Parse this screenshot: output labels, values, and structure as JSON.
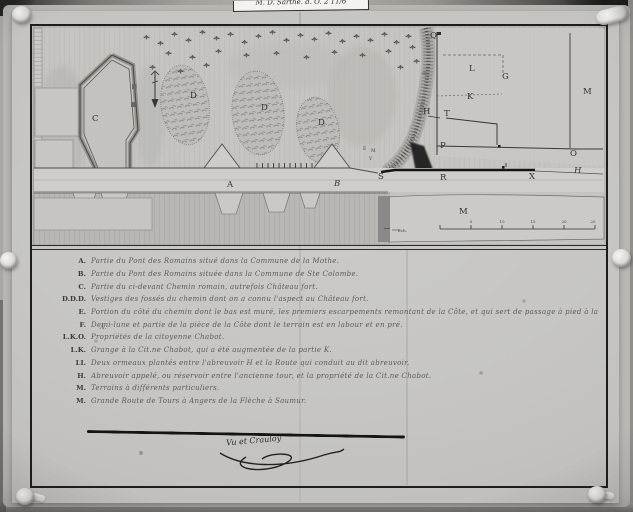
{
  "photo": {
    "archive_label": "M. D. Sarthe. d. O. 2 11/6"
  },
  "map": {
    "letters": [
      "C",
      "D",
      "D",
      "D",
      "A",
      "B",
      "Q",
      "L",
      "G",
      "K",
      "M",
      "H",
      "T",
      "P",
      "O",
      "S",
      "R",
      "X",
      "H",
      "M",
      "E",
      "M",
      "V"
    ],
    "scale": {
      "caption": "Ech.",
      "ticks": [
        "5",
        "10",
        "15",
        "20",
        "25"
      ]
    }
  },
  "legend": {
    "sub_note": "A.",
    "entries": [
      {
        "key": "A.",
        "text": "Partie du Pont des Romains situé dans la Commune de la Mothe."
      },
      {
        "key": "B.",
        "text": "Partie du Pont des Romains située dans la Commune de Ste Colombe."
      },
      {
        "key": "C.",
        "text": "Partie du ci-devant Chemin romain, autrefois Château fort."
      },
      {
        "key": "D.D.D.",
        "text": "Vestiges des fossés du chemin dont on a connu l'aspect au Château fort."
      },
      {
        "key": "E.",
        "text": "Portion du côté du chemin dont le bas est muré, les premiers escarpements remontant de la Côte, et qui sert de passage à pied à la Grande Route détaillée du Pont des Romains."
      },
      {
        "key": "F.",
        "text": "Demi-lune et partie de la pièce de la Côte dont le terrain est en labour et en pré."
      },
      {
        "key": "L.K.O.",
        "text": "Propriétés de la citoyenne Chabot."
      },
      {
        "key": "L.K.",
        "text": "Grange à la Cit.ne Chabot, qui a été augmentée de la partie K."
      },
      {
        "key": "LI.",
        "text": "Deux ormeaux plantés entre l'abreuvoir H et la Route qui conduit au dit abreuvoir."
      },
      {
        "key": "H.",
        "text": "Abreuvoir appelé, ou réservoir entre l'ancienne tour, et la propriété de la Cit.ne Chabot."
      },
      {
        "key": "M.",
        "text": "Terrains à différents particuliers."
      },
      {
        "key": "M.",
        "text": "Grande Route de Tours à Angers de la Flèche à Saumur."
      }
    ]
  },
  "signature": {
    "text": "Vu et Crauloy"
  },
  "colors": {
    "paper": "#c8c7c3",
    "ink": "#1c1c1a",
    "backdrop": "#3f3f3d"
  }
}
